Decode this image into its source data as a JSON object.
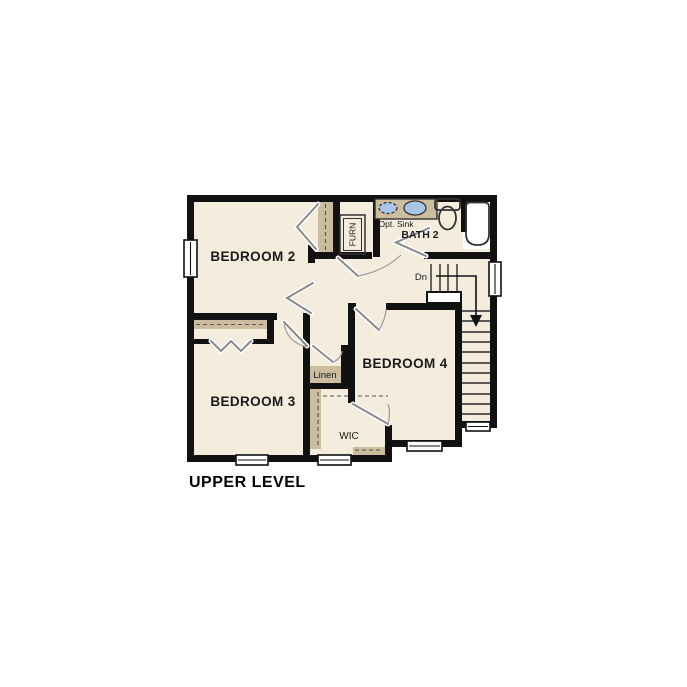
{
  "page": {
    "title": "UPPER LEVEL"
  },
  "floor_plan": {
    "rooms": {
      "bedroom2": "BEDROOM 2",
      "bedroom3": "BEDROOM 3",
      "bedroom4": "BEDROOM 4",
      "bath2": "BATH 2"
    },
    "features": {
      "furnace": "FURN",
      "linen": "Linen",
      "wic": "WIC",
      "stairs_down": "Dn",
      "opt_sink": "Opt. Sink"
    },
    "colors": {
      "wall": "#111111",
      "floor": "#f4ecdc",
      "shelf": "#cbbd9e",
      "fixture": "#a9c6e6",
      "door": "#8a8a8a",
      "text": "#1a1a1a",
      "background": "#ffffff"
    }
  }
}
